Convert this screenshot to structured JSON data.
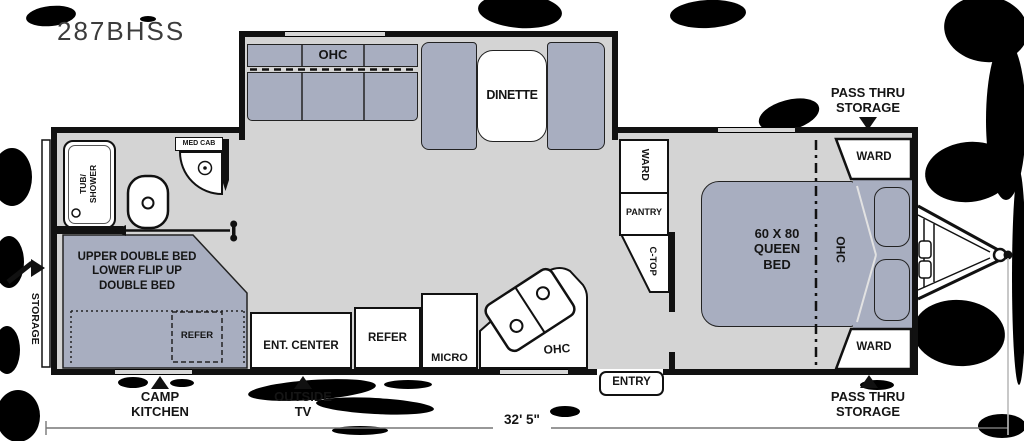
{
  "title": "287BHSS",
  "colors": {
    "wall": "#111111",
    "floor": "#d4d4d4",
    "furniture": "#a8aec0",
    "text": "#151515"
  },
  "labels": {
    "sofa_ohc": "OHC",
    "dinette": "DINETTE",
    "tub_shower_line1": "TUB/",
    "tub_shower_line2": "SHOWER",
    "med_cab": "MED CAB",
    "ward_column": "WARD",
    "pantry": "PANTRY",
    "c_top": "C-TOP",
    "bunk_line1": "UPPER DOUBLE BED",
    "bunk_line2": "LOWER FLIP UP",
    "bunk_line3": "DOUBLE BED",
    "bunk_refer": "REFER",
    "ent_center": "ENT. CENTER",
    "refer": "REFER",
    "micro": "MICRO",
    "kitchen_ohc": "OHC",
    "entry": "ENTRY",
    "bed_line1": "60 X 80",
    "bed_line2": "QUEEN",
    "bed_line3": "BED",
    "bed_ohc": "OHC",
    "ward_front_top": "WARD",
    "ward_front_bottom": "WARD"
  },
  "exterior": {
    "storage_left": "STORAGE",
    "camp_kitchen_line1": "CAMP",
    "camp_kitchen_line2": "KITCHEN",
    "outside_tv_line1": "OUTSIDE",
    "outside_tv_line2": "TV",
    "pass_thru_line1": "PASS THRU",
    "pass_thru_line2": "STORAGE",
    "length_dimension": "32' 5\""
  }
}
